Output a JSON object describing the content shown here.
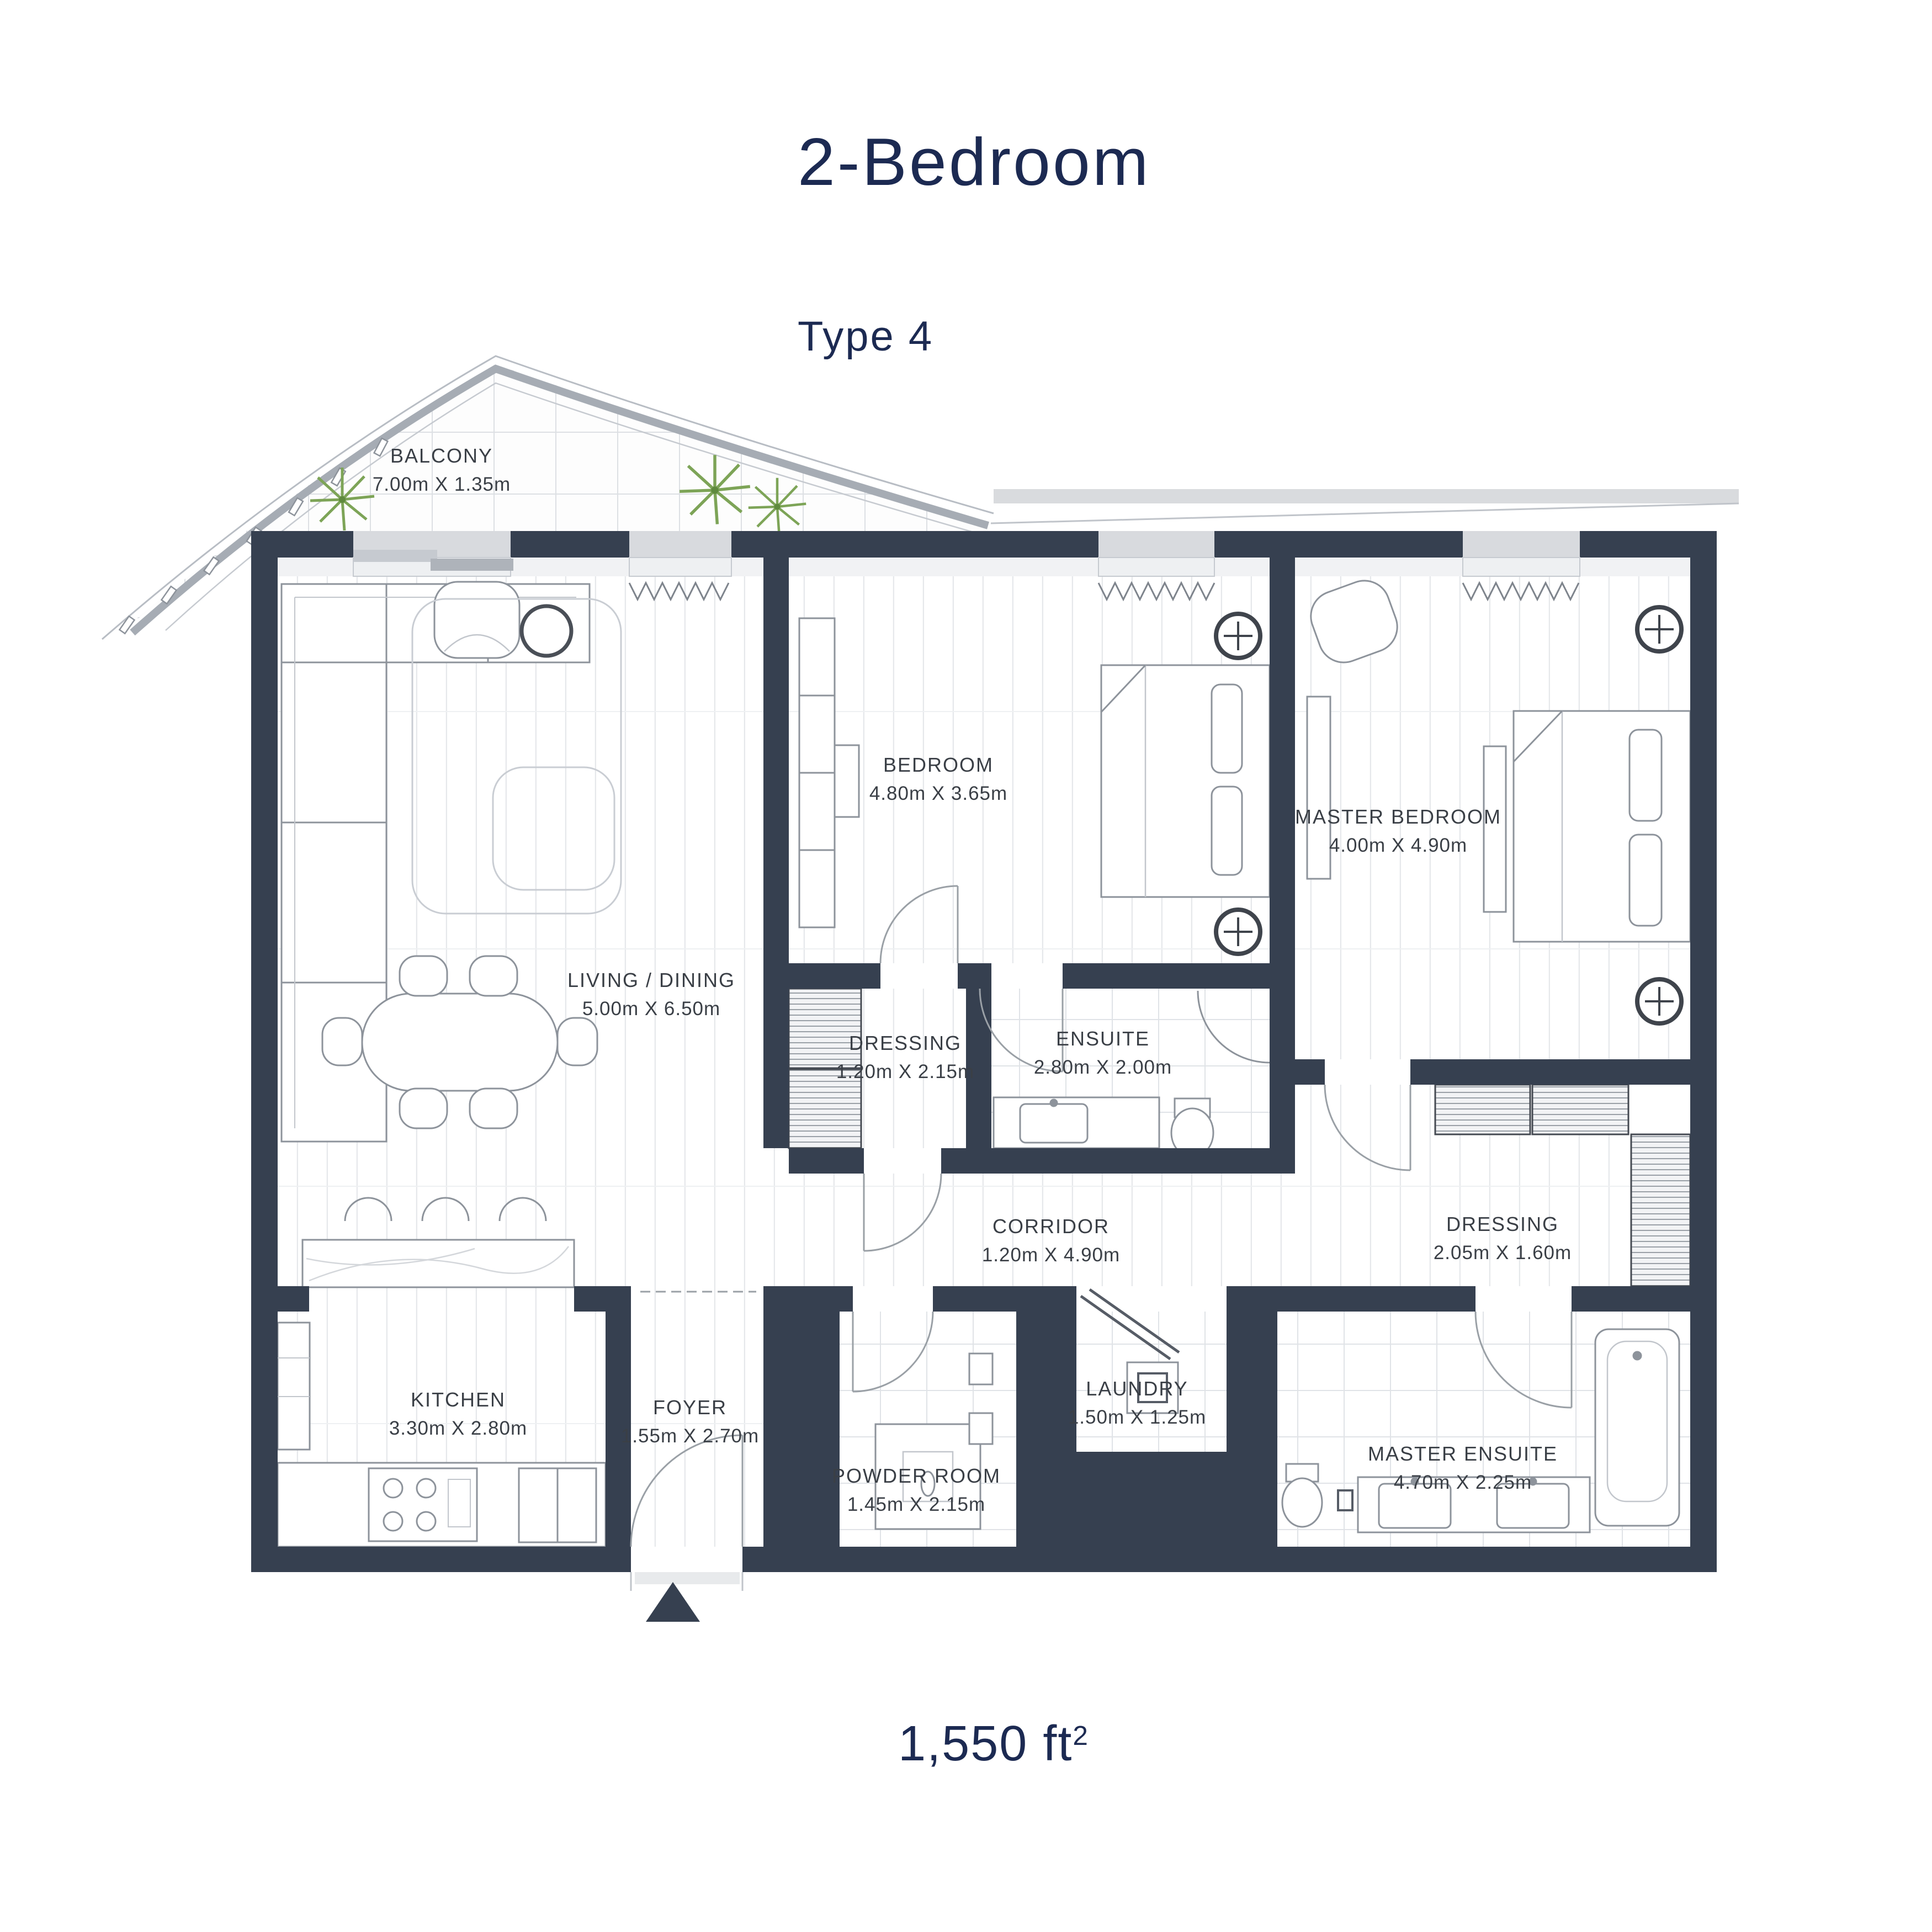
{
  "page": {
    "title": "2-Bedroom",
    "subtitle": "Type 4",
    "area_text": "1,550 ft",
    "area_sup": "2"
  },
  "colors": {
    "wall": "#364050",
    "window": "#d8dade",
    "title_text": "#1c2a52",
    "label_text": "#3a3f46",
    "furniture_line": "#8d939b",
    "plant_green": "#7da457"
  },
  "rooms": {
    "balcony": {
      "name": "BALCONY",
      "dims": "7.00m X 1.35m"
    },
    "living": {
      "name": "LIVING / DINING",
      "dims": "5.00m X 6.50m"
    },
    "bedroom": {
      "name": "BEDROOM",
      "dims": "4.80m X 3.65m"
    },
    "master_bedroom": {
      "name": "MASTER BEDROOM",
      "dims": "4.00m X 4.90m"
    },
    "dressing1": {
      "name": "DRESSING",
      "dims": "1.20m X 2.15m"
    },
    "ensuite": {
      "name": "ENSUITE",
      "dims": "2.80m X 2.00m"
    },
    "corridor": {
      "name": "CORRIDOR",
      "dims": "1.20m X 4.90m"
    },
    "dressing2": {
      "name": "DRESSING",
      "dims": "2.05m X 1.60m"
    },
    "kitchen": {
      "name": "KITCHEN",
      "dims": "3.30m X 2.80m"
    },
    "foyer": {
      "name": "FOYER",
      "dims": "1.55m X 2.70m"
    },
    "powder": {
      "name": "POWDER ROOM",
      "dims": "1.45m X 2.15m"
    },
    "laundry": {
      "name": "LAUNDRY",
      "dims": "1.50m X 1.25m"
    },
    "master_ensuite": {
      "name": "MASTER ENSUITE",
      "dims": "4.70m X 2.25m"
    }
  }
}
